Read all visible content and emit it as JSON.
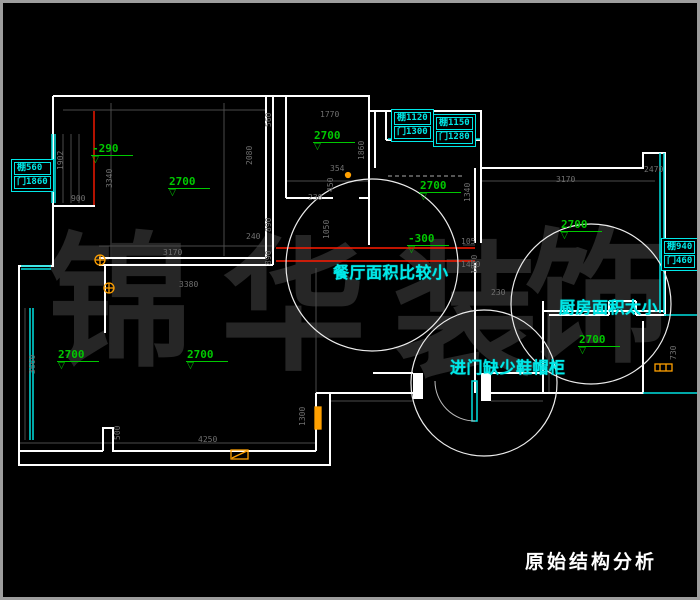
{
  "title": "原始结构分析",
  "watermark": {
    "chars": [
      {
        "ch": "锦",
        "x": 44,
        "y": 228
      },
      {
        "ch": "华",
        "x": 218,
        "y": 232
      },
      {
        "ch": "装",
        "x": 390,
        "y": 238
      },
      {
        "ch": "饰",
        "x": 522,
        "y": 224
      }
    ]
  },
  "callouts": [
    {
      "id": "dining",
      "text": "餐厅面积比较小",
      "x": 330,
      "y": 256
    },
    {
      "id": "kitchen",
      "text": "厨房面积太小",
      "x": 556,
      "y": 291
    },
    {
      "id": "entry",
      "text": "进门缺少鞋帽柜",
      "x": 447,
      "y": 351
    }
  ],
  "info_boxes": [
    {
      "id": "left-beam",
      "lines": [
        "棚560",
        "门1860"
      ],
      "x": 8,
      "y": 156
    },
    {
      "id": "top-beam-1",
      "lines": [
        "棚1120",
        "门1300"
      ],
      "x": 388,
      "y": 106
    },
    {
      "id": "top-beam-2",
      "lines": [
        "棚1150",
        "门1280"
      ],
      "x": 430,
      "y": 111
    },
    {
      "id": "right-beam",
      "lines": [
        "棚940",
        "门460"
      ],
      "x": 658,
      "y": 235
    }
  ],
  "elevation_markers": [
    {
      "label": "-290",
      "x": 88,
      "y": 139
    },
    {
      "label": "2700",
      "x": 165,
      "y": 172
    },
    {
      "label": "2700",
      "x": 310,
      "y": 126
    },
    {
      "label": "2700",
      "x": 416,
      "y": 176
    },
    {
      "label": "2700",
      "x": 557,
      "y": 215
    },
    {
      "label": "-300",
      "x": 404,
      "y": 229
    },
    {
      "label": "2700",
      "x": 575,
      "y": 330
    },
    {
      "label": "2700",
      "x": 54,
      "y": 345
    },
    {
      "label": "2700",
      "x": 183,
      "y": 345
    }
  ],
  "dimensions": [
    {
      "t": "3170",
      "x": 160,
      "y": 246
    },
    {
      "t": "3380",
      "x": 176,
      "y": 278
    },
    {
      "t": "1770",
      "x": 317,
      "y": 108
    },
    {
      "t": "560",
      "x": 262,
      "y": 124,
      "v": 1
    },
    {
      "t": "2080",
      "x": 243,
      "y": 162,
      "v": 1
    },
    {
      "t": "1860",
      "x": 355,
      "y": 157,
      "v": 1
    },
    {
      "t": "450",
      "x": 324,
      "y": 189,
      "v": 1
    },
    {
      "t": "354",
      "x": 327,
      "y": 162
    },
    {
      "t": "230",
      "x": 305,
      "y": 191
    },
    {
      "t": "890",
      "x": 262,
      "y": 229,
      "v": 1
    },
    {
      "t": "240",
      "x": 243,
      "y": 230
    },
    {
      "t": "890",
      "x": 262,
      "y": 262,
      "v": 1
    },
    {
      "t": "1050",
      "x": 320,
      "y": 236,
      "v": 1
    },
    {
      "t": "105",
      "x": 458,
      "y": 235
    },
    {
      "t": "1870",
      "x": 468,
      "y": 271,
      "v": 1
    },
    {
      "t": "3170",
      "x": 553,
      "y": 173
    },
    {
      "t": "2470",
      "x": 641,
      "y": 163
    },
    {
      "t": "1340",
      "x": 461,
      "y": 199,
      "v": 1
    },
    {
      "t": "900",
      "x": 68,
      "y": 192
    },
    {
      "t": "1902",
      "x": 54,
      "y": 167,
      "v": 1
    },
    {
      "t": "3340",
      "x": 103,
      "y": 185,
      "v": 1
    },
    {
      "t": "3660",
      "x": 26,
      "y": 371,
      "v": 1
    },
    {
      "t": "500",
      "x": 111,
      "y": 437,
      "v": 1
    },
    {
      "t": "4250",
      "x": 195,
      "y": 433
    },
    {
      "t": "1300",
      "x": 296,
      "y": 423,
      "v": 1
    },
    {
      "t": "730",
      "x": 667,
      "y": 357,
      "v": 1
    },
    {
      "t": "230",
      "x": 488,
      "y": 286
    },
    {
      "t": "1440",
      "x": 458,
      "y": 258
    }
  ],
  "colors": {
    "background": "#000000",
    "frame": "#9e9e9e",
    "wall": "#ffffff",
    "window": "#00e0e0",
    "callout": "#00e8e8",
    "elevation": "#00c800",
    "beam_line": "#ff1a00",
    "door_symbol": "#ffa000",
    "dimension": "#707070",
    "watermark": "#262626",
    "circle": "#ededed",
    "title": "#ffffff"
  }
}
